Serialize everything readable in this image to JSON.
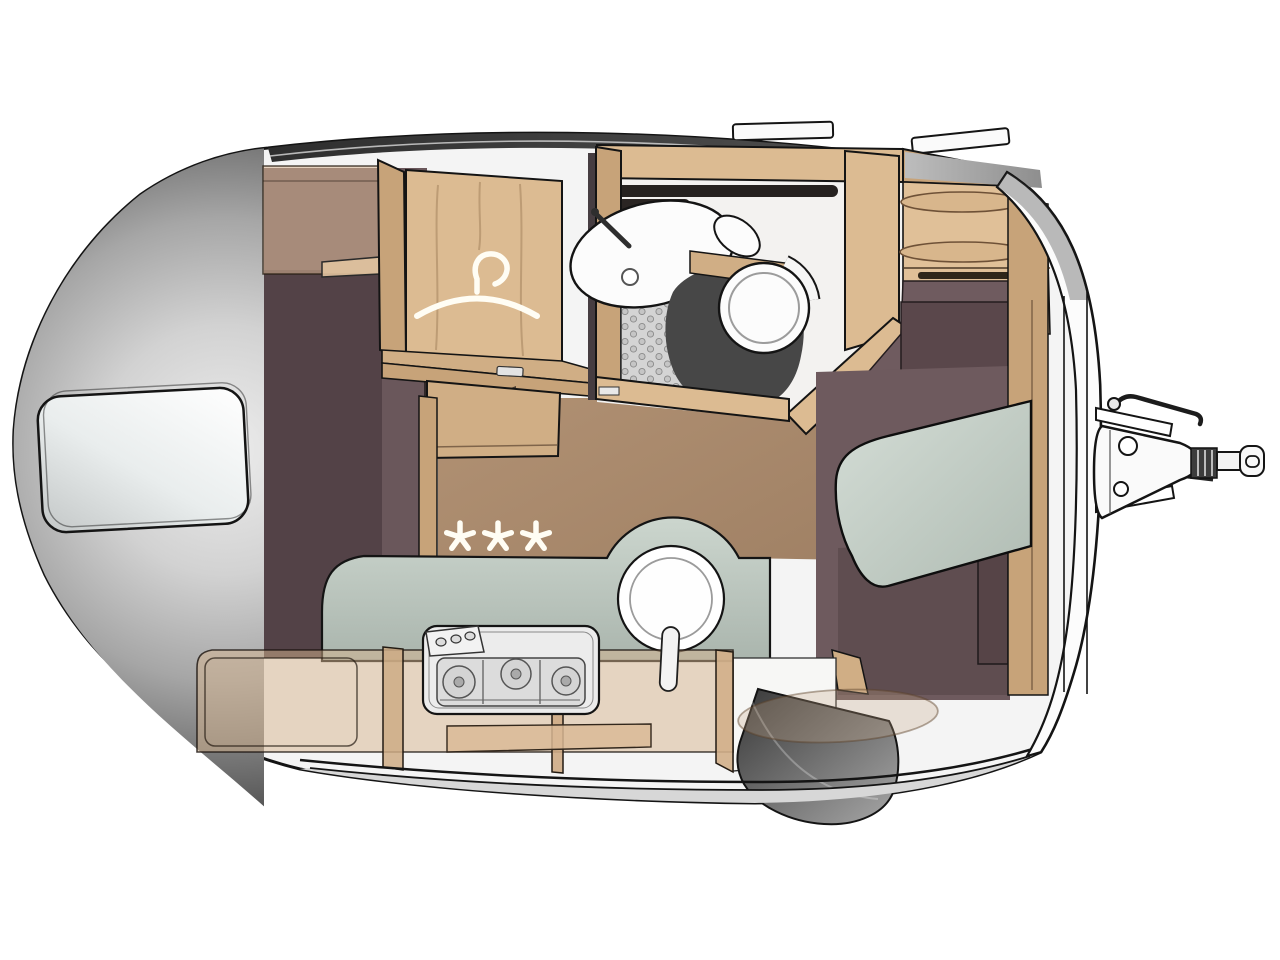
{
  "meta": {
    "description": "Top-view interior floor plan illustration of a teardrop caravan / travel trailer",
    "view": "overhead cutaway",
    "visible_text": "none (pictorial diagram only)"
  },
  "symbols": {
    "comfort_stars": "✱ ✱ ✱",
    "star_count": 3,
    "hanger_icon": "clothes-hanger"
  },
  "areas": {
    "body": "caravan body shell",
    "window": "rear panoramic window",
    "roof_vents": "roof vents",
    "bed": "rear bed under roof",
    "overhead_locker": "overhead locker above bed",
    "wardrobe": "wardrobe with hanger symbol",
    "washroom": "washroom with sink, shower floor and toilet",
    "front_shelves": "front overhead shelves",
    "kitchen": "kitchenette with sink and three-burner hob",
    "lower_cabinets": "lower cabinets and drawers",
    "seating": "front seating bench",
    "entrance": "entrance with step",
    "drawbar": "drawbar with coupling hitch",
    "floor": "walkway floor"
  },
  "palette": {
    "line": "#141414",
    "body": "#f4f4f4",
    "smoke_dark": "#2b2b2b",
    "roof_band": "#3a3a3a",
    "window_glass": "#e9eded",
    "wood": "#dcbb92",
    "wood_dark": "#c7a379",
    "wood_light": "#e0c098",
    "wood_mid": "#d0ae85",
    "bed": "#6a575b",
    "bed_shadow": "#574649",
    "backrest": "#6e5a5e",
    "under_seat": "#5f4d50",
    "floor_tan": "#a98a6c",
    "counter_sage": "#c7d1c9",
    "cushion_sage": "#ccd6ce",
    "shower_gray": "#d4d4d4",
    "fixture_white": "#fcfcfc",
    "shroud": "#474747",
    "step_dark": "#3f3f3f",
    "skirt": "#d7d7d7",
    "cabinet_overlay": "rgba(214,179,142,0.5)",
    "star": "#fffdf4"
  }
}
